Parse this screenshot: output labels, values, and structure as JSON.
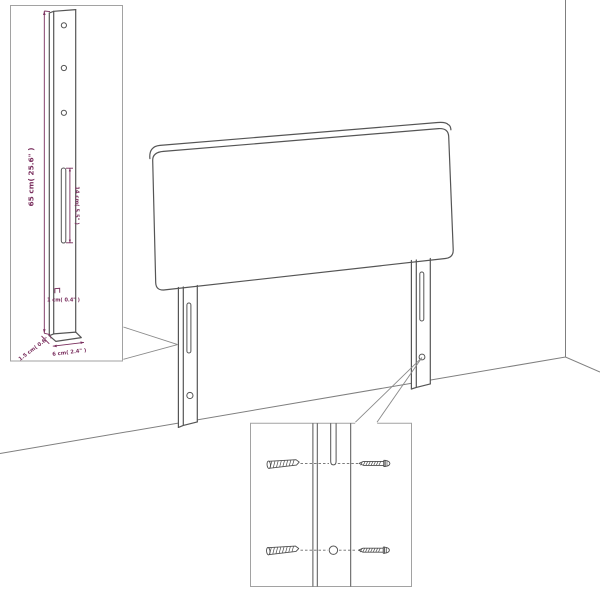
{
  "palette": {
    "background": "#ffffff",
    "furniture_line": "#555555",
    "room_line": "#7f7f7f",
    "callout_border": "#a2a2a2",
    "dimension_color": "#7a2f5e"
  },
  "scene": {
    "subject": "upholstered-headboard-with-two-wall-mount-legs",
    "left_leg": {
      "slot": true,
      "hole": true
    },
    "right_leg": {
      "slot": true,
      "hole": true
    }
  },
  "leg_dimension_callout": {
    "height_label": "65 cm( 25.6\" )",
    "slot_length_label": "14 cm( 5.5\" )",
    "slot_width_label": "1 cm( 0.4\" )",
    "depth_label": "1.5 cm( 0.6\" )",
    "width_label": "6 cm( 2.4\" )",
    "hole_count": 3
  },
  "hardware_callout": {
    "anchors": [
      "wall-plug",
      "wall-plug"
    ],
    "fasteners": [
      "screw",
      "screw"
    ]
  }
}
